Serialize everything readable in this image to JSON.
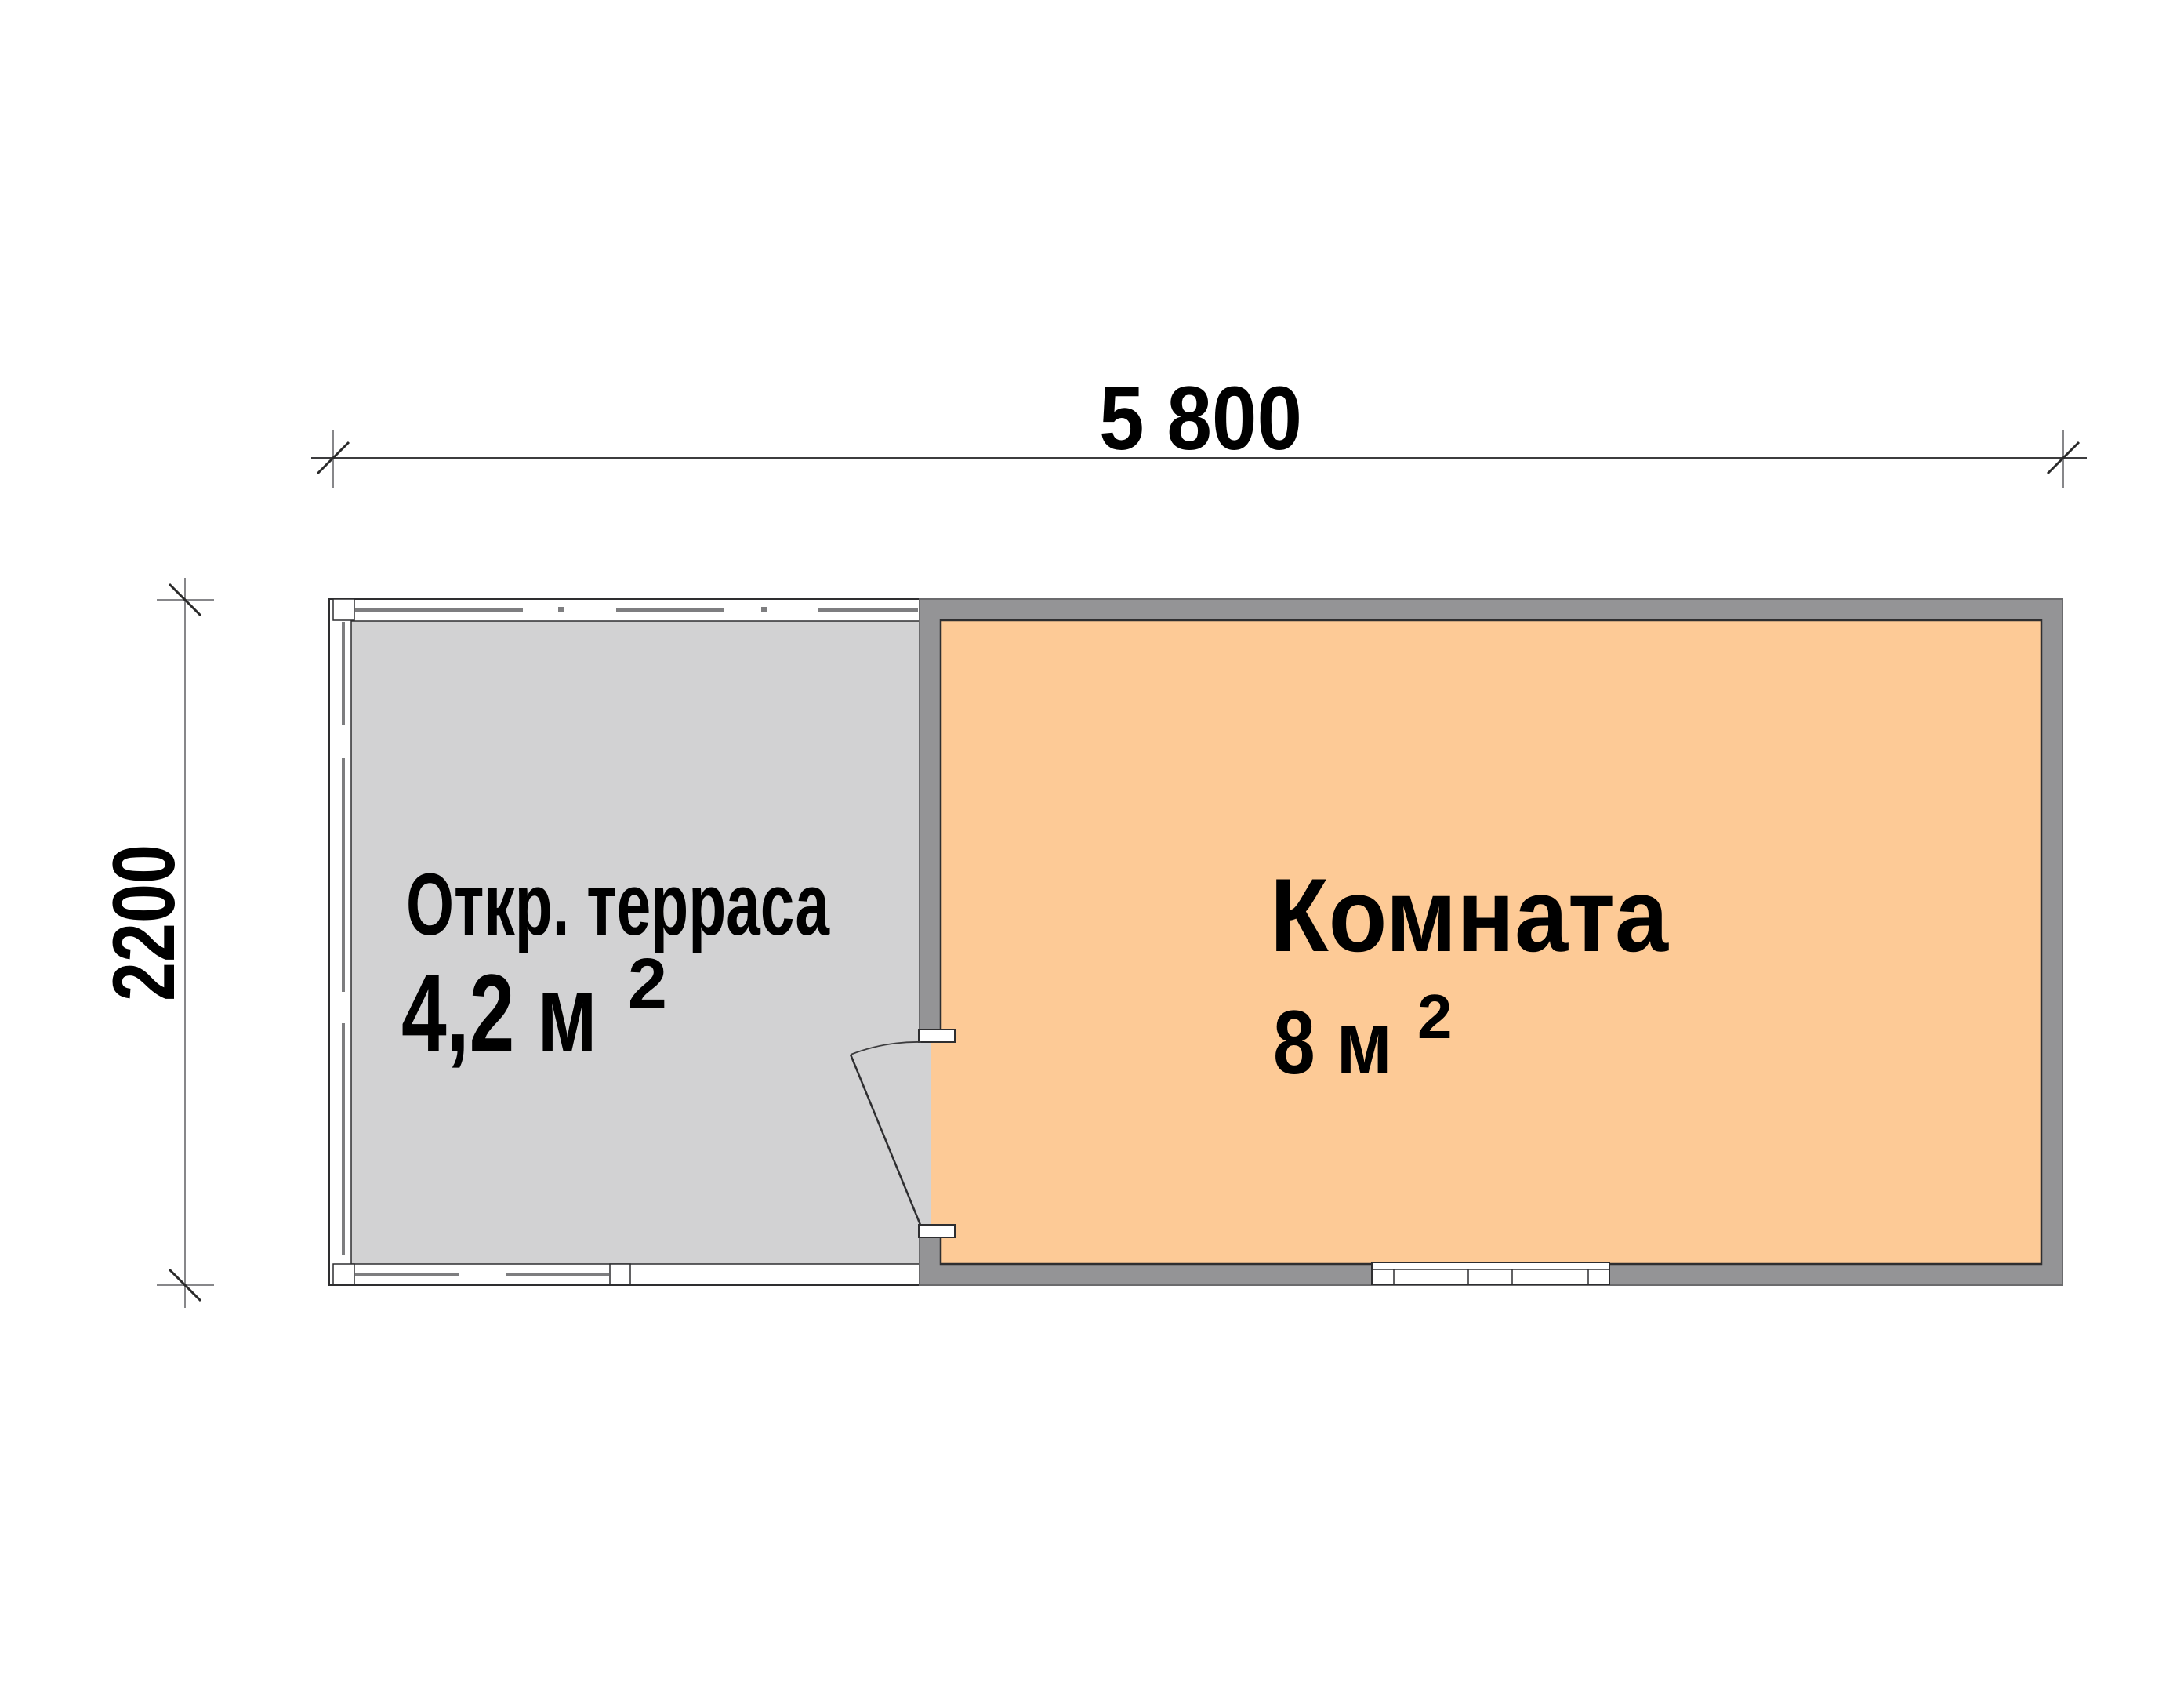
{
  "colors": {
    "background": "#ffffff",
    "room_fill": "#fdca96",
    "terrace_fill": "#d2d2d3",
    "wall_fill": "#949496",
    "wall_edge": "#6b6b6d",
    "outline": "#2e2e30",
    "railing": "#7e7e80",
    "dim_line": "#3c3c3e",
    "ext_line": "#87878a",
    "label_text": "#000000"
  },
  "dimensions": {
    "width_label": "5 800",
    "height_label": "2200"
  },
  "terrace": {
    "name": "Откр. терраса",
    "area": "4,2 м",
    "area_sup": "2"
  },
  "room": {
    "name": "Комната",
    "area": "8 м",
    "area_sup": "2"
  }
}
